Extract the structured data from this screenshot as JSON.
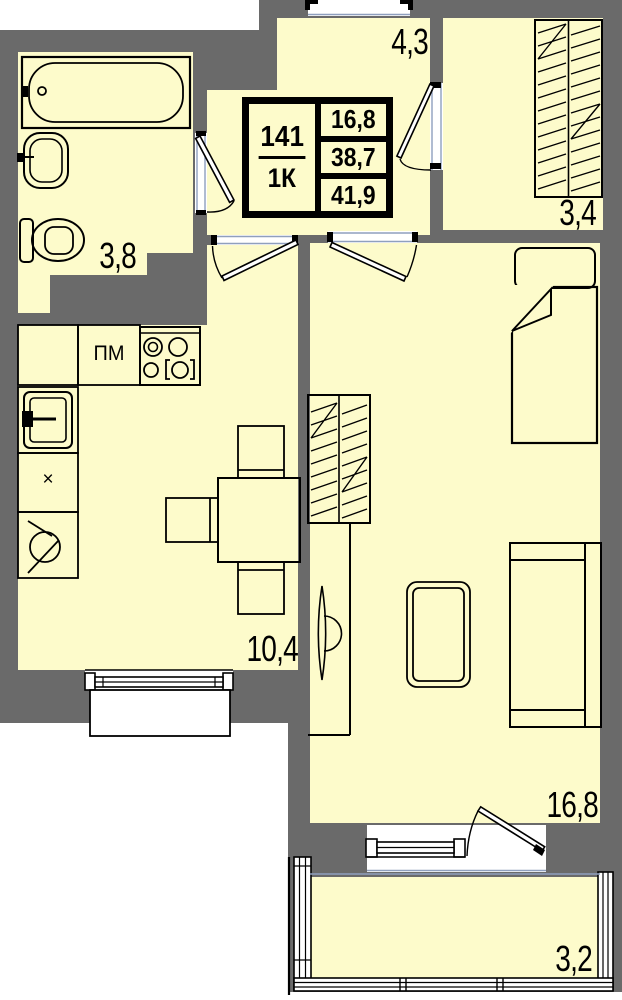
{
  "unit": {
    "number": "141",
    "type": "1К"
  },
  "area_summary": {
    "living": "16,8",
    "apartment": "38,7",
    "total": "41,9"
  },
  "room_labels": {
    "hallway": "4,3",
    "wardrobe_room": "3,4",
    "bathroom": "3,8",
    "kitchen": "10,4",
    "living_room": "16,8",
    "balcony": "3,2"
  },
  "kitchen_marks": {
    "dishwasher": "ПМ",
    "x_mark": "×"
  },
  "colors": {
    "wall": "#6A6A6A",
    "floor": "#FDFBCB",
    "outline": "#000000",
    "exterior": "#FFFFFF",
    "opening_line": "#8F9FBE"
  },
  "furniture_symbols": [
    "bathtub",
    "wash-sink",
    "toilet",
    "kitchen-sink",
    "dishwasher",
    "stove",
    "fridge",
    "dining-table",
    "chair",
    "closet",
    "bed",
    "pillow",
    "tv",
    "coffee-table",
    "sofa"
  ]
}
